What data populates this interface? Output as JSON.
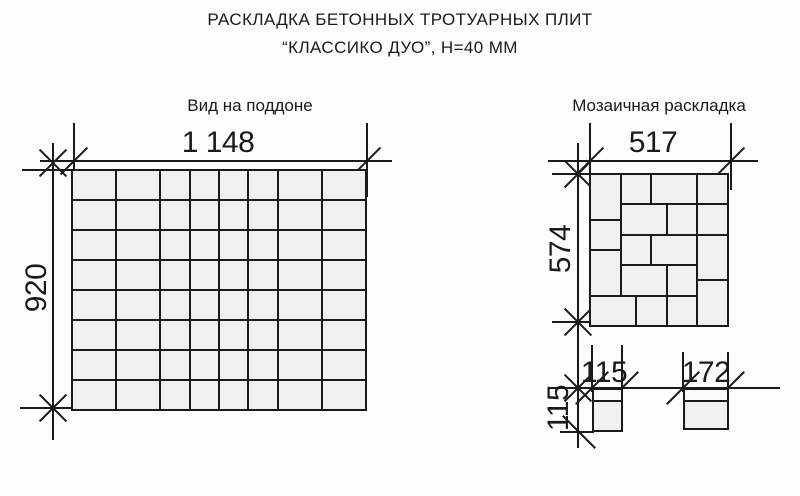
{
  "title": {
    "line1": "РАСКЛАДКА БЕТОННЫХ ТРОТУАРНЫХ ПЛИТ",
    "line2": "“КЛАССИКО ДУО”, Н=40 ММ"
  },
  "pallet": {
    "heading": "Вид на поддоне",
    "width_label": "1 148",
    "height_label": "920",
    "width_mm": 1148,
    "height_mm": 920,
    "columns_mm": [
      172,
      172,
      115,
      115,
      115,
      115,
      172,
      172
    ],
    "rows": 8,
    "row_height_mm": 115
  },
  "mosaic": {
    "heading": "Мозаичная раскладка",
    "width_label": "517",
    "height_label": "574",
    "module_mm": {
      "w": 517,
      "h": 574
    },
    "blocks_mm": [
      {
        "x": 0,
        "y": 0,
        "w": 115,
        "h": 172
      },
      {
        "x": 0,
        "y": 172,
        "w": 115,
        "h": 115
      },
      {
        "x": 0,
        "y": 287,
        "w": 115,
        "h": 172
      },
      {
        "x": 115,
        "y": 0,
        "w": 115,
        "h": 115
      },
      {
        "x": 230,
        "y": 0,
        "w": 172,
        "h": 115
      },
      {
        "x": 402,
        "y": 0,
        "w": 115,
        "h": 115
      },
      {
        "x": 115,
        "y": 115,
        "w": 172,
        "h": 115
      },
      {
        "x": 287,
        "y": 115,
        "w": 115,
        "h": 115
      },
      {
        "x": 402,
        "y": 115,
        "w": 115,
        "h": 115
      },
      {
        "x": 115,
        "y": 230,
        "w": 115,
        "h": 115
      },
      {
        "x": 230,
        "y": 230,
        "w": 172,
        "h": 115
      },
      {
        "x": 402,
        "y": 230,
        "w": 115,
        "h": 172
      },
      {
        "x": 115,
        "y": 344,
        "w": 172,
        "h": 115
      },
      {
        "x": 287,
        "y": 344,
        "w": 115,
        "h": 115
      },
      {
        "x": 402,
        "y": 402,
        "w": 115,
        "h": 172
      },
      {
        "x": 0,
        "y": 459,
        "w": 172,
        "h": 115
      },
      {
        "x": 172,
        "y": 459,
        "w": 115,
        "h": 115
      },
      {
        "x": 287,
        "y": 459,
        "w": 115,
        "h": 115
      }
    ]
  },
  "slabs": {
    "square": {
      "width_label": "115",
      "height_label": "115"
    },
    "rect": {
      "width_label": "172"
    }
  },
  "colors": {
    "line": "#1a1a1a",
    "slab_fill": "#f0f0f0",
    "background": "#fdfdfd"
  }
}
